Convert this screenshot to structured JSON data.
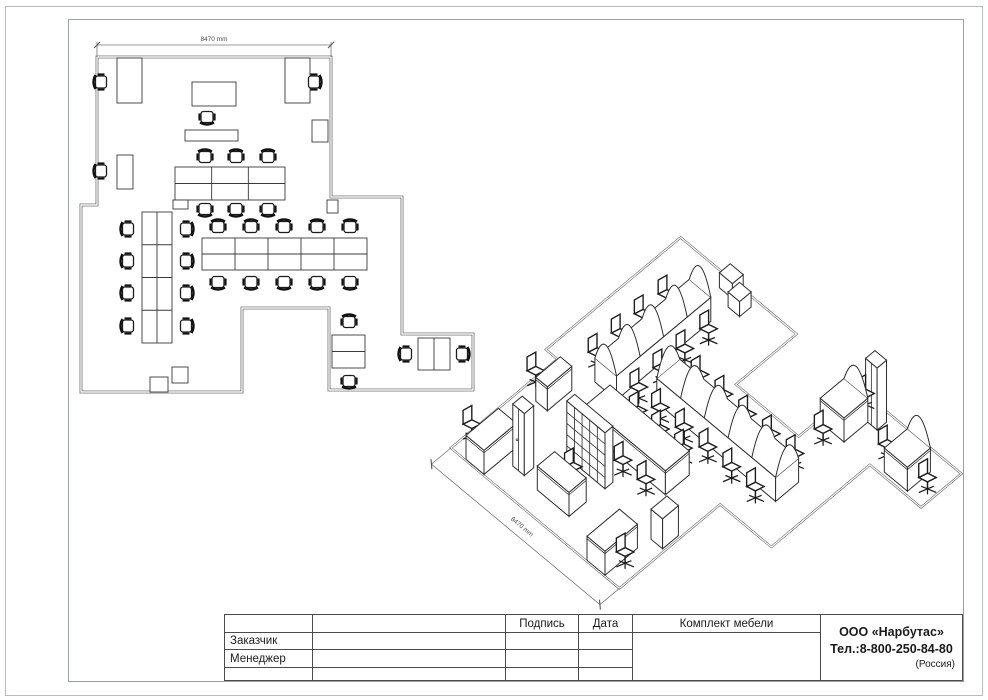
{
  "title_block": {
    "signature": "Подпись",
    "date": "Дата",
    "customer": "Заказчик",
    "manager": "Менеджер",
    "set": "Комплект мебели",
    "company": "ООО «Нарбутас»",
    "phone": "Тел.:8-800-250-84-80",
    "country": "(Россия)"
  },
  "plan": {
    "dim": {
      "x1": 97,
      "x2": 331,
      "y": 45,
      "label": "8470 mm"
    },
    "outline": [
      [
        97,
        57
      ],
      [
        331,
        57
      ],
      [
        331,
        197
      ],
      [
        402,
        197
      ],
      [
        402,
        334
      ],
      [
        473,
        334
      ],
      [
        473,
        390
      ],
      [
        329,
        390
      ],
      [
        329,
        308
      ],
      [
        242,
        308
      ],
      [
        242,
        392
      ],
      [
        81,
        392
      ],
      [
        81,
        205
      ],
      [
        97,
        205
      ]
    ],
    "desks": [
      {
        "x": 117,
        "y": 58,
        "w": 25,
        "h": 45,
        "cols": 1,
        "rows": 1
      },
      {
        "x": 285,
        "y": 58,
        "w": 25,
        "h": 45,
        "cols": 1,
        "rows": 1
      },
      {
        "x": 192,
        "y": 82,
        "w": 44,
        "h": 24,
        "cols": 1,
        "rows": 1
      },
      {
        "x": 117,
        "y": 155,
        "w": 16,
        "h": 34,
        "cols": 1,
        "rows": 1
      },
      {
        "x": 175,
        "y": 167,
        "w": 110,
        "h": 33,
        "cols": 3,
        "rows": 2
      },
      {
        "x": 142,
        "y": 212,
        "w": 30,
        "h": 131,
        "cols": 2,
        "rows": 4
      },
      {
        "x": 202,
        "y": 238,
        "w": 165,
        "h": 32,
        "cols": 5,
        "rows": 2
      },
      {
        "x": 332,
        "y": 335,
        "w": 33,
        "h": 33,
        "cols": 1,
        "rows": 2
      },
      {
        "x": 418,
        "y": 338,
        "w": 32,
        "h": 32,
        "cols": 2,
        "rows": 1
      },
      {
        "x": 185,
        "y": 130,
        "w": 53,
        "h": 11,
        "cols": 1,
        "rows": 1
      },
      {
        "x": 312,
        "y": 120,
        "w": 16,
        "h": 22,
        "cols": 1,
        "rows": 1
      },
      {
        "x": 173,
        "y": 200,
        "w": 15,
        "h": 9,
        "cols": 1,
        "rows": 1
      },
      {
        "x": 327,
        "y": 200,
        "w": 11,
        "h": 13,
        "cols": 1,
        "rows": 1
      },
      {
        "x": 150,
        "y": 377,
        "w": 18,
        "h": 15,
        "cols": 1,
        "rows": 1
      },
      {
        "x": 172,
        "y": 367,
        "w": 16,
        "h": 16,
        "cols": 1,
        "rows": 1
      }
    ],
    "chairs": [
      [
        101,
        82,
        270
      ],
      [
        314,
        82,
        90
      ],
      [
        207,
        117,
        180
      ],
      [
        101,
        171,
        270
      ],
      [
        205,
        157,
        0
      ],
      [
        236,
        157,
        0
      ],
      [
        268,
        157,
        0
      ],
      [
        205,
        209,
        180
      ],
      [
        236,
        209,
        180
      ],
      [
        268,
        209,
        180
      ],
      [
        128,
        229,
        270
      ],
      [
        128,
        261,
        270
      ],
      [
        128,
        293,
        270
      ],
      [
        128,
        326,
        270
      ],
      [
        186,
        229,
        90
      ],
      [
        186,
        261,
        90
      ],
      [
        186,
        293,
        90
      ],
      [
        186,
        326,
        90
      ],
      [
        218,
        227,
        0
      ],
      [
        251,
        227,
        0
      ],
      [
        284,
        227,
        0
      ],
      [
        317,
        227,
        0
      ],
      [
        350,
        227,
        0
      ],
      [
        218,
        282,
        180
      ],
      [
        251,
        282,
        180
      ],
      [
        284,
        282,
        180
      ],
      [
        317,
        282,
        180
      ],
      [
        350,
        282,
        180
      ],
      [
        349,
        322,
        0
      ],
      [
        349,
        381,
        180
      ],
      [
        406,
        354,
        270
      ],
      [
        462,
        354,
        90
      ]
    ]
  },
  "iso": {
    "t": {
      "ox": 340,
      "oy": 424,
      "a": 0.72,
      "b": 0.6
    },
    "outline": [
      [
        97,
        57
      ],
      [
        331,
        57
      ],
      [
        331,
        197
      ],
      [
        402,
        197
      ],
      [
        402,
        334
      ],
      [
        473,
        334
      ],
      [
        473,
        390
      ],
      [
        329,
        390
      ],
      [
        329,
        308
      ],
      [
        242,
        308
      ],
      [
        242,
        392
      ],
      [
        81,
        392
      ],
      [
        81,
        205
      ],
      [
        97,
        205
      ]
    ],
    "dim": {
      "from": [
        97,
        30
      ],
      "to": [
        331,
        30
      ],
      "label": "8470 mm"
    },
    "items": [
      {
        "type": "box",
        "name": "pedestal",
        "u": 150,
        "v": 377,
        "w": 18,
        "d": 15,
        "h": 15
      },
      {
        "type": "box",
        "name": "pedestal",
        "u": 172,
        "v": 367,
        "w": 16,
        "d": 16,
        "h": 15
      },
      {
        "type": "archrow",
        "name": "bench-desk-row",
        "u": 142,
        "v": 212,
        "w": 30,
        "d": 131,
        "h": 24,
        "axis": "v",
        "bays": 4,
        "back": [
          [
            128,
            229
          ],
          [
            128,
            261
          ],
          [
            128,
            293
          ],
          [
            128,
            326
          ]
        ],
        "front": [
          [
            186,
            229
          ],
          [
            186,
            261
          ],
          [
            186,
            293
          ],
          [
            186,
            326
          ]
        ]
      },
      {
        "type": "archrow",
        "name": "bench-desk-row",
        "u": 202,
        "v": 238,
        "w": 165,
        "d": 32,
        "h": 24,
        "axis": "u",
        "bays": 5,
        "back": [
          [
            218,
            282
          ],
          [
            251,
            282
          ],
          [
            284,
            282
          ],
          [
            317,
            282
          ],
          [
            350,
            282
          ]
        ],
        "front": [
          [
            218,
            227
          ],
          [
            251,
            227
          ],
          [
            284,
            227
          ],
          [
            317,
            227
          ],
          [
            350,
            227
          ]
        ]
      },
      {
        "type": "box",
        "name": "conference-table",
        "u": 175,
        "v": 167,
        "w": 110,
        "d": 33,
        "h": 24,
        "back": [
          [
            205,
            209
          ],
          [
            236,
            209
          ],
          [
            268,
            209
          ]
        ],
        "front": [
          [
            205,
            157
          ],
          [
            236,
            157
          ],
          [
            268,
            157
          ]
        ]
      },
      {
        "type": "archdesk",
        "name": "desk",
        "u": 332,
        "v": 335,
        "w": 33,
        "d": 33,
        "h": 24,
        "back": [
          [
            349,
            381
          ]
        ],
        "front": [
          [
            349,
            322
          ]
        ]
      },
      {
        "type": "archdesk",
        "name": "desk",
        "u": 418,
        "v": 338,
        "w": 32,
        "d": 32,
        "h": 24,
        "back": [
          [
            406,
            354
          ]
        ],
        "front": [
          [
            462,
            354
          ]
        ]
      },
      {
        "type": "box",
        "name": "desk",
        "u": 117,
        "v": 58,
        "w": 25,
        "d": 45,
        "h": 24,
        "back": [
          [
            101,
            82
          ]
        ],
        "front": []
      },
      {
        "type": "box",
        "name": "desk",
        "u": 285,
        "v": 58,
        "w": 25,
        "d": 45,
        "h": 24,
        "back": [],
        "front": [
          [
            314,
            82
          ]
        ]
      },
      {
        "type": "box",
        "name": "desk",
        "u": 192,
        "v": 82,
        "w": 44,
        "d": 24,
        "h": 24,
        "back": [
          [
            207,
            117
          ]
        ],
        "front": []
      },
      {
        "type": "box",
        "name": "desk",
        "u": 117,
        "v": 155,
        "w": 16,
        "d": 34,
        "h": 24,
        "back": [
          [
            101,
            171
          ]
        ],
        "front": []
      },
      {
        "type": "shelf",
        "name": "shelving-unit",
        "u": 185,
        "v": 130,
        "w": 53,
        "d": 11,
        "h": 56,
        "cols": 5,
        "rows": 5
      },
      {
        "type": "cabinet",
        "name": "wardrobe-cabinet",
        "u": 155,
        "v": 85,
        "w": 16,
        "d": 13,
        "h": 62
      },
      {
        "type": "cabinet",
        "name": "wardrobe-cabinet",
        "u": 362,
        "v": 368,
        "w": 16,
        "d": 13,
        "h": 62
      },
      {
        "type": "box",
        "name": "low-cabinet",
        "u": 312,
        "v": 120,
        "w": 16,
        "d": 22,
        "h": 30
      }
    ]
  }
}
